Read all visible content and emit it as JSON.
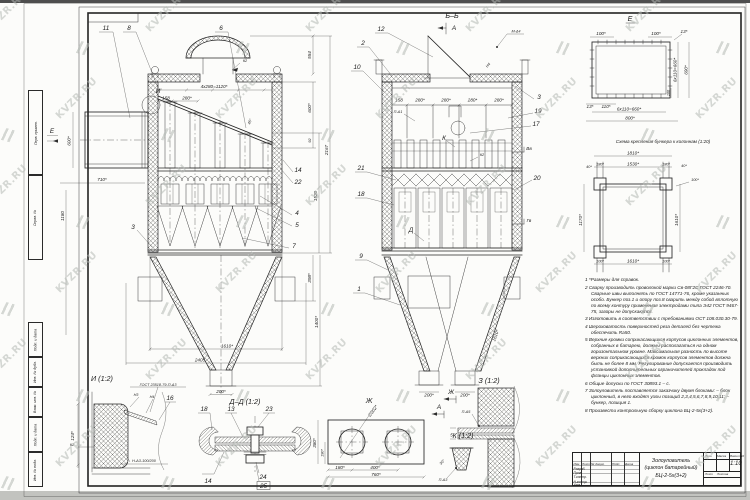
{
  "watermark": {
    "text": "KVZR.RU"
  },
  "margin_boxes": {
    "labels": [
      "Перв. примен.",
      "Справ. №",
      "Подп. и дата",
      "Инв. № дубл.",
      "Взам. инв. №",
      "Подп. и дата",
      "Инв. № подл."
    ]
  },
  "front_view": {
    "view_e_label": "Е",
    "callouts": {
      "c11": "11",
      "c8": "8",
      "c6": "6",
      "c14": "14",
      "c22": "22",
      "c4": "4",
      "c5": "5",
      "c3": "3",
      "c7": "7",
      "k2": "К2",
      "detail_i": "И"
    },
    "dims": {
      "pitch": "4х280=1120*",
      "d158": "158",
      "d280": "280*",
      "ang45": "45°",
      "inlet_h": "600*",
      "inlet_w": "710*",
      "d1180": "1180",
      "d554": "554",
      "d600": "600*",
      "d92": "92",
      "d2167": "2167",
      "d1520": "1520",
      "d398": "398*",
      "d1400": "1400*",
      "d1610": "1610*",
      "d2405": "2405",
      "d200": "200*"
    }
  },
  "section_view": {
    "title": "Б–Б",
    "arrow_a": "А",
    "callouts": {
      "c12": "12",
      "c2": "2",
      "c10": "10",
      "c21": "21",
      "c18": "18",
      "c9": "9",
      "c1": "1",
      "c3": "3",
      "c19": "19",
      "c17": "17",
      "c20": "20",
      "k": "К",
      "k2": "К2",
      "d": "Д",
      "weld_m4": "М-Δ4",
      "weld_n4": "Н4",
      "weld_p1": "П-Δ1"
    },
    "levels": {
      "upper": "Вв",
      "lower": "Гв"
    },
    "dims": {
      "d158": "158",
      "d280": "280*",
      "out1": "200*",
      "out2": "200*",
      "slope": "1610*"
    },
    "view_arrows": {
      "zh": "Ж",
      "a": "А"
    }
  },
  "e_view": {
    "title": "Е",
    "dims": {
      "d100a": "100*",
      "d100b": "100*",
      "d13t": "13*",
      "v660": "6х110=660*",
      "v690": "690*",
      "v100": "100",
      "d13b": "13*",
      "d110": "110*",
      "b660": "6х110=660*",
      "b800": "800*"
    }
  },
  "scheme": {
    "title": "Схема крепления бункера к колоннам (1:20)",
    "dims": {
      "w1810": "1810*",
      "d180a": "180*",
      "d1530": "1530*",
      "d180b": "180*",
      "d40r": "40*",
      "d100r": "100*",
      "d40l": "40*",
      "v1170": "1170*",
      "v1610": "1610*",
      "b100a": "100*",
      "b1610": "1610*",
      "b100b": "100*"
    }
  },
  "details": {
    "i": {
      "title": "И (1:2)",
      "gost": "ГОСТ 23518-79-П-Δ3",
      "n3": "Н3",
      "n4": "Н4",
      "c16": "16",
      "d124": "124*",
      "k2": "К2",
      "weld": "Н-Δ3-100/200"
    },
    "dd": {
      "title": "Д–Д (1:2)",
      "c18": "18",
      "c13": "13",
      "c23": "23",
      "c14": "14",
      "c24": "24",
      "c25": "25"
    },
    "zh": {
      "title": "Ж",
      "dia": "∅302*",
      "d180": "180*",
      "d400": "400*",
      "d760": "760*",
      "d380": "380*",
      "d190": "190*"
    },
    "z": {
      "title": "З (1:2)",
      "weld": "П-Δ5",
      "d5": "5"
    },
    "k": {
      "title": "К (1:2)",
      "weld": "П-Δ3",
      "ang": "30°"
    }
  },
  "notes": {
    "items": [
      "1 *Размеры для справок.",
      "2 Сварку производить проволокой марки Св-08Г2С ГОСТ 2246-70. Сварные швы выполнять по ГОСТ 14771-76, кроме указанных особо. Бункер поз.1 и опору поз.8 сварить между собой вплотную по всему контуру применения электродами типа Э42 ГОСТ 9467-75, зазоры не допускаются.",
      "3 Изготовить в соответствии с требованиями ОСТ 108.030.30-79.",
      "4 Шероховатость поверхностей реза деталей без чертежа обеспечить Ra50.",
      "5 Верхние кромки соприкасающихся корпусов циклонных элементов, собранных в батарею, должны располагаться на одном горизонтальном уровне. Максимальная разность по высоте верхних соприкасающихся кромок корпусов элементов должна быть не более 8 мм. Регулирование допускается производить установкой дополнительных ограничителей прокладок под фланцы циклонных элементов.",
      "6 Общие допуски по ГОСТ 30893.1 – с.",
      "7 Золоуловитель поставляется заказчику двумя блоками: – блок циклонный, в него входят узлы позиций 2,3,4,5,6,7,8,9,10,11; – бункер, позиция 1.",
      "8 Произвести контрольную сборку циклона БЦ-2-5х(3+2)."
    ]
  },
  "title_block": {
    "cols": [
      "Изм.",
      "Лист",
      "№ докум.",
      "Подп.",
      "Дата"
    ],
    "rows": [
      "Разраб.",
      "Пров.",
      "Т.контр.",
      "Н.контр.",
      "Утв."
    ],
    "name_line1": "Золоуловитель",
    "name_line2": "(циклон батарейный)",
    "name_line3": "БЦ-2-5х(3+2)",
    "lit": "Лит.",
    "mass": "Масса",
    "scale_label": "Масштаб",
    "scale": "1:10",
    "sheet_label": "Лист",
    "sheets_label": "Листов"
  }
}
